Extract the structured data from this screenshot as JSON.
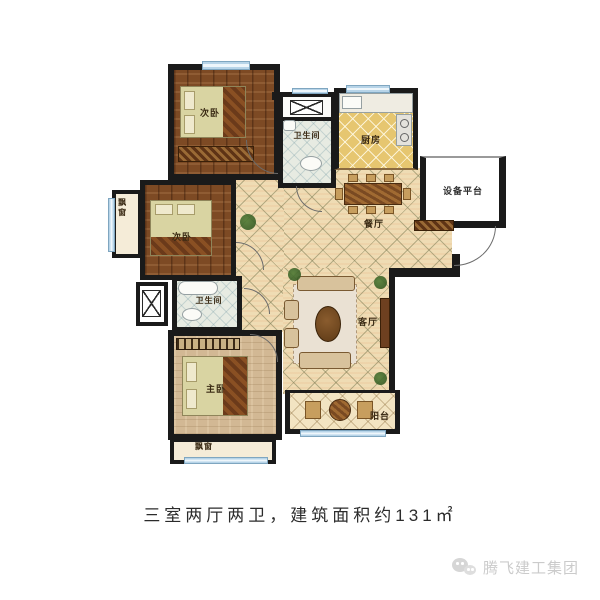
{
  "plan": {
    "rooms": {
      "bedroom_top": "次卧",
      "bedroom_mid": "次卧",
      "master": "主卧",
      "bath_top": "卫生间",
      "bath_mid": "卫生间",
      "kitchen": "厨房",
      "dining": "餐厅",
      "living": "客厅",
      "balcony": "阳台",
      "platform": "设备平台",
      "bay_left": "飘窗",
      "bay_bottom": "飘窗"
    },
    "colors": {
      "wall": "#1a1a1a",
      "window": "#b7d4e8",
      "wood_floor": "#7d4a24",
      "hall_tile": "#efdcb4",
      "kitchen_tile": "#e6c670",
      "bath_tile": "#e7ebe2",
      "master_floor": "#d2b894",
      "bed": "#d9d4a2"
    }
  },
  "caption": "三室两厅两卫，建筑面积约131㎡",
  "watermark": {
    "brand": "腾飞建工集团",
    "icon": "wechat-icon"
  }
}
